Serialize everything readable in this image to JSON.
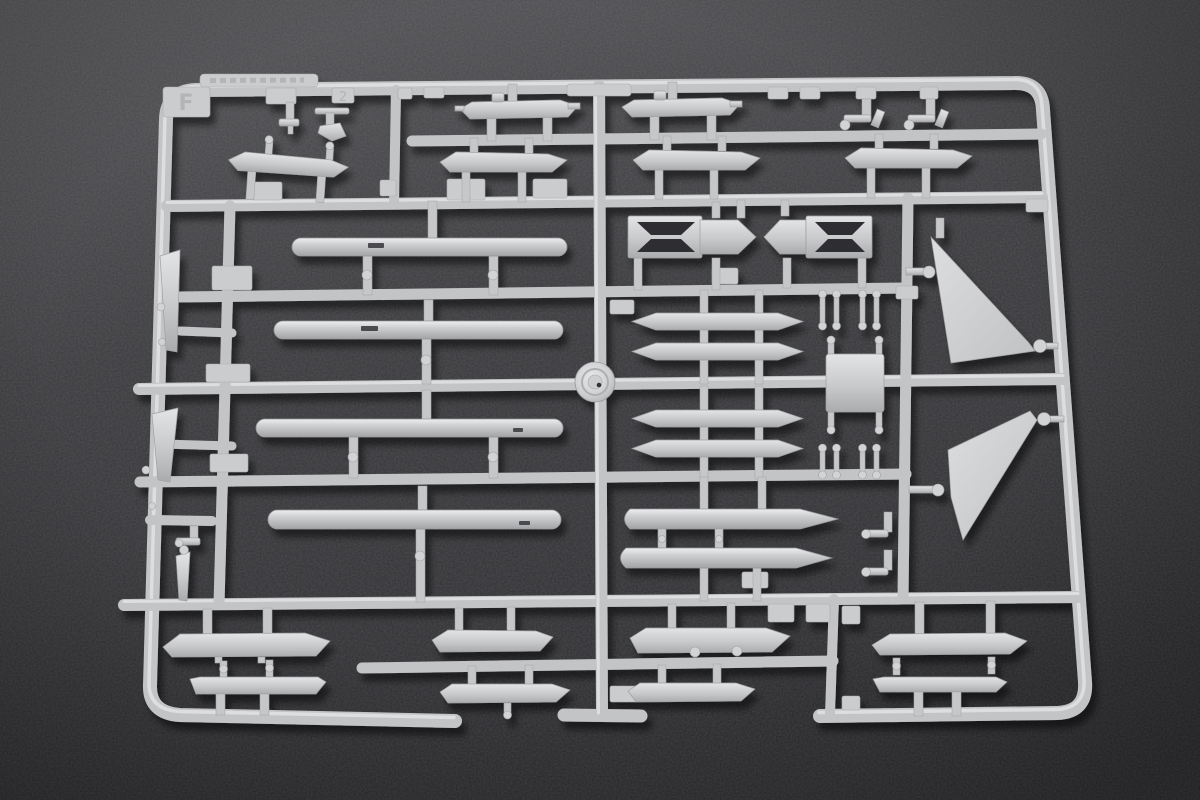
{
  "scene": {
    "description": "Macro photograph of an unpainted light-grey injection-moulded plastic model kit sprue (runner) holding aircraft weapon parts, lying on a dark mottled grey surface",
    "sprue_tab_letter": "F",
    "embossed_gate_number": "2"
  },
  "colors": {
    "background_top": "#545457",
    "background_mid": "#38383b",
    "background_bottom": "#2c2c2f",
    "plastic_base": "#c3c4c6",
    "plastic_highlight": "#e8e9ea",
    "plastic_shadow": "#95969a",
    "cutout_dark": "#2e2e31",
    "cast_shadow": "#000000"
  },
  "parts_inventory": {
    "drop_tanks": 4,
    "winged_pylons_upper_rows": 6,
    "pylons_bottom_rows": 8,
    "missile_launch_rails": 4,
    "missile_bodies": 2,
    "trapezoid_tail_fins": 2,
    "x_frame_adapters": 2,
    "round_disc_part": 1,
    "small_brackets_standoffs_probes": 16
  }
}
